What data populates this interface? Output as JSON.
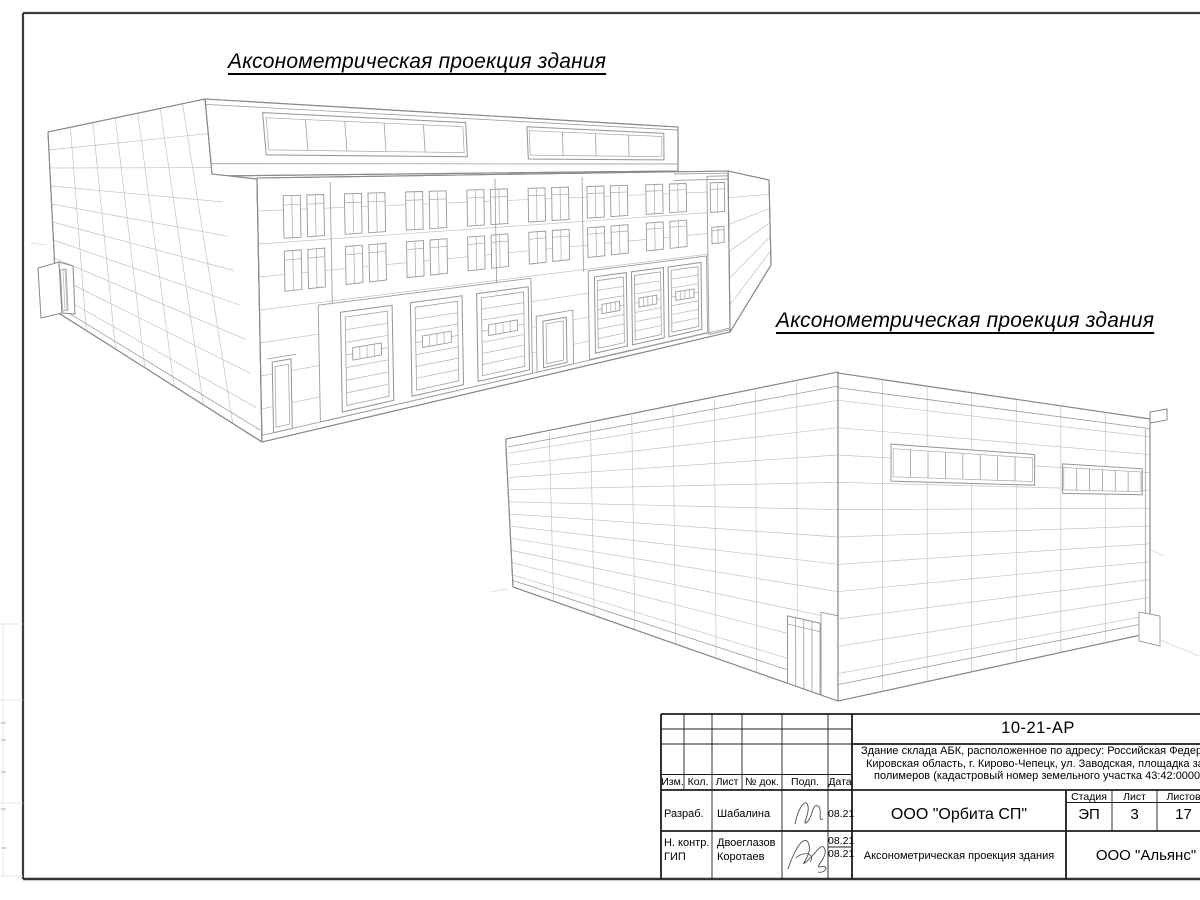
{
  "sheet": {
    "background": "#ffffff",
    "frame_color": "#3d3d3d",
    "line_color": "#8a8a8a"
  },
  "titles": {
    "view1": "Аксонометрическая проекция здания",
    "view2": "Аксонометрическая проекция здания"
  },
  "title_block": {
    "doc_number": "10-21-АР",
    "description_lines": [
      "Здание склада АБК, расположенное по адресу: Российская Федерац",
      "Кировская область, г. Кирово-Чепецк, ул. Заводская, площадка заво",
      "полимеров (кадастровый номер земельного участка 43:42:000022:"
    ],
    "revision_columns": {
      "izm": "Изм.",
      "kol": "Кол.",
      "list": "Лист",
      "doc": "№ док.",
      "podp": "Подп.",
      "data": "Дата"
    },
    "rows": [
      {
        "role": "Разраб.",
        "name": "Шабалина",
        "date": "08.21"
      },
      {
        "role": "Н. контр.",
        "name": "Двоеглазов",
        "date": "08.21"
      },
      {
        "role": "ГИП",
        "name": "Коротаев",
        "date": "08.21"
      }
    ],
    "org": "ООО \"Орбита СП\"",
    "stage_label": "Стадия",
    "sheet_label": "Лист",
    "sheets_label": "Листов",
    "stage": "ЭП",
    "sheet_number": "3",
    "sheets_total": "17",
    "sheet_title": "Аксонометрическая проекция здания",
    "contractor": "ООО \"Альянс\""
  }
}
